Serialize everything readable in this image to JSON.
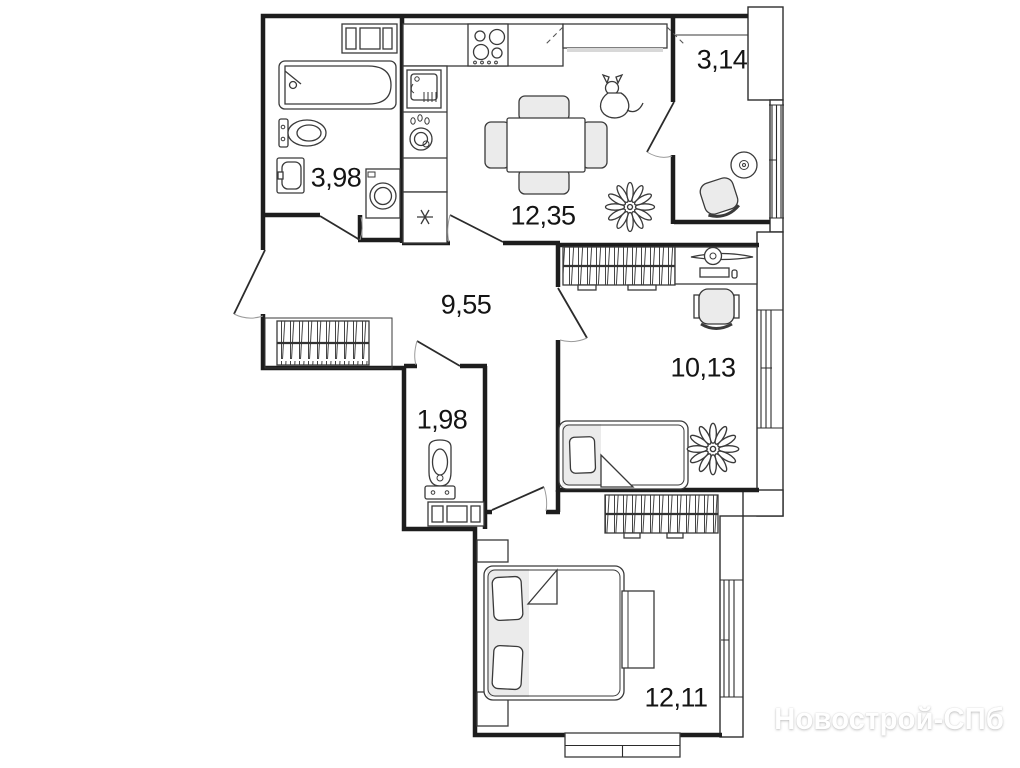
{
  "watermark": "Новострой-СПб",
  "rooms": {
    "bathroom": {
      "area": "3,98"
    },
    "kitchen": {
      "area": "12,35"
    },
    "balcony": {
      "area": "3,14"
    },
    "hallway": {
      "area": "9,55"
    },
    "wc": {
      "area": "1,98"
    },
    "bedroom_top": {
      "area": "10,13"
    },
    "bedroom_bottom": {
      "area": "12,11"
    }
  },
  "fixtures": {
    "bathroom": [
      "cabinet-icon",
      "bathtub-icon",
      "toilet-icon",
      "washbasin-icon",
      "washing-machine-icon"
    ],
    "kitchen": [
      "kitchen-sink-icon",
      "kettle-icon",
      "hob-icon",
      "fridge-snowflake-icon",
      "upper-cabinet-icon",
      "dining-table-icon",
      "chair-icon",
      "pet-dog-icon",
      "plant-icon"
    ],
    "balcony": [
      "round-table-icon",
      "armchair-icon"
    ],
    "hallway": [
      "wardrobe-icon"
    ],
    "wc": [
      "toilet-icon",
      "vanity-cabinet-icon"
    ],
    "bedroom_top": [
      "wardrobe-icon",
      "desk-icon",
      "monitor-icon",
      "office-chair-icon",
      "single-bed-icon",
      "plant-icon"
    ],
    "bedroom_bottom": [
      "wardrobe-icon",
      "double-bed-icon",
      "bench-icon"
    ]
  },
  "colors": {
    "wall": "#1d1d1d",
    "line": "#3a3a3a",
    "light_fill": "#ebebeb",
    "watermark_color": "#ffffff"
  }
}
